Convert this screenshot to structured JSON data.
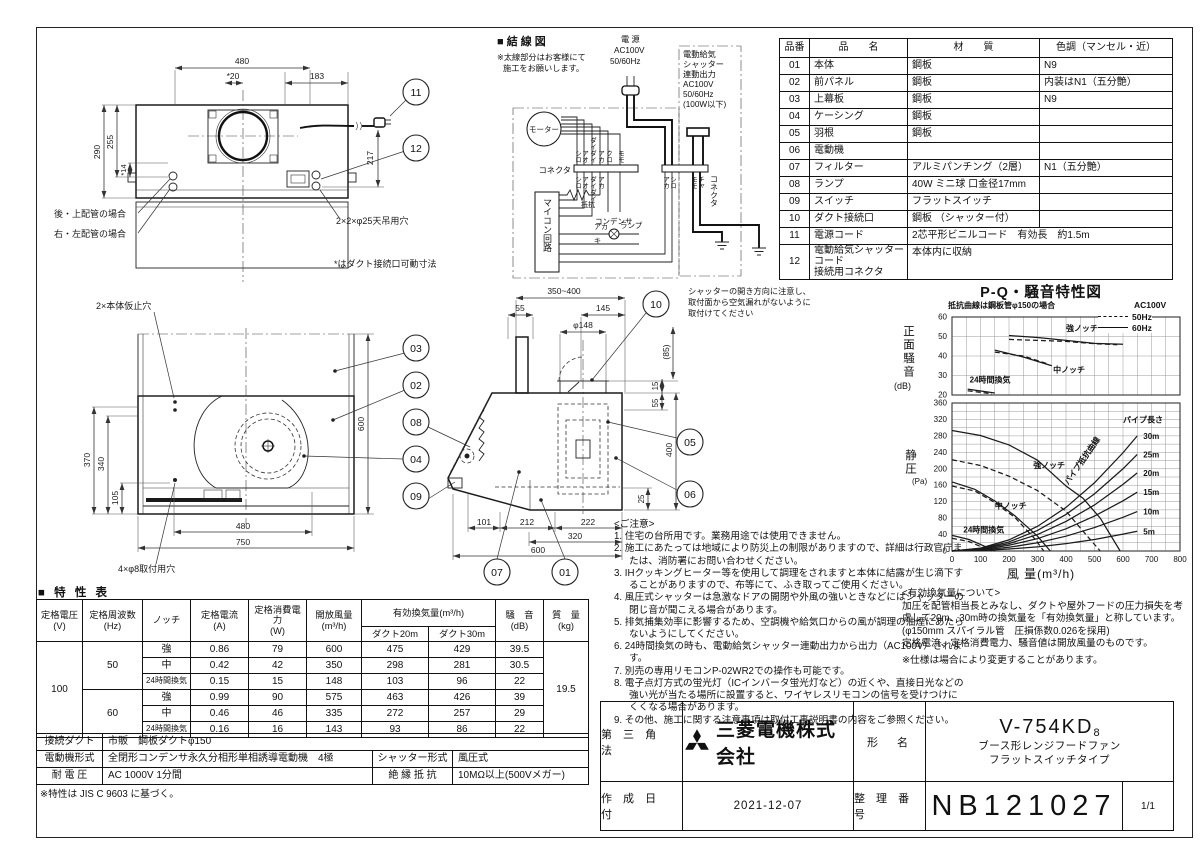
{
  "top_view": {
    "dims": {
      "w480": "480",
      "w20": "*20",
      "w183": "183",
      "h290": "290",
      "h255": "255",
      "h14": "*14",
      "h217": "217"
    },
    "labels": {
      "rear_top": "後・上配管の場合",
      "right_left": "右・左配管の場合",
      "ceiling_holes": "2×2×φ25天吊用穴",
      "movable_note": "*はダクト接続口可動寸法"
    },
    "callout_11": "11",
    "callout_12": "12"
  },
  "front_view": {
    "dims": {
      "h370": "370",
      "h340": "340",
      "h105": "105",
      "h600": "600",
      "w480": "480",
      "w750": "750"
    },
    "labels": {
      "temp_holes": "2×本体仮止穴",
      "mount_holes": "4×φ8取付用穴"
    },
    "callouts": {
      "c03": "03",
      "c02": "02",
      "c08": "08",
      "c04": "04",
      "c09": "09"
    }
  },
  "side_view": {
    "dims": {
      "w350400": "350~400",
      "w55": "55",
      "w145": "145",
      "d148": "φ148",
      "h85": "(85)",
      "h15": "15",
      "h55": "55",
      "h400": "400",
      "h25": "25",
      "w101": "101",
      "w212": "212",
      "w222": "222",
      "w320": "320",
      "w600": "600"
    },
    "note_lines": [
      "シャッターの開き方向に注意し、",
      "取付面から空気漏れがないように",
      "取付けてください"
    ],
    "callouts": {
      "c10": "10",
      "c05": "05",
      "c06": "06",
      "c07": "07",
      "c01": "01"
    }
  },
  "wiring": {
    "title": "■ 結 線 図",
    "note_line1": "※太線部分はお客様にて",
    "note_line2": "施工をお願いします。",
    "power": {
      "l1": "電 源",
      "l2": "AC100V",
      "l3": "50/60Hz"
    },
    "shutter_out": {
      "l1": "電動給気",
      "l2": "シャッター",
      "l3": "連動出力",
      "l4": "AC100V",
      "l5": "50/60Hz",
      "l6": "(100W以下)"
    },
    "motor": "モーター",
    "connector_l": "コネクタ",
    "connector_r": "コネクタ",
    "micon": "マイコン回路",
    "condenser": "コンデンサ",
    "resistor": "抵抗",
    "lamp": "ランプ",
    "wires_top": [
      "シロ",
      "アオ",
      "ダイダイ",
      "アカ",
      "クロ",
      "モモ"
    ],
    "wires_bottom": [
      "シロ",
      "アオ",
      "ダイダイ",
      "アカ"
    ],
    "wires_right": [
      "アカ",
      "シロ",
      "モモ",
      "チャ"
    ],
    "lamp_wire_red": "アカ",
    "lamp_wire_yellow": "キ"
  },
  "parts_table": {
    "headers": [
      "品番",
      "品　　名",
      "材　　質",
      "色調（マンセル・近）"
    ],
    "rows": [
      {
        "no": "01",
        "name": "本体",
        "material": "鋼板",
        "color": "N9"
      },
      {
        "no": "02",
        "name": "前パネル",
        "material": "鋼板",
        "color": "内装はN1（五分艶）"
      },
      {
        "no": "03",
        "name": "上幕板",
        "material": "鋼板",
        "color": "N9"
      },
      {
        "no": "04",
        "name": "ケーシング",
        "material": "鋼板",
        "color": ""
      },
      {
        "no": "05",
        "name": "羽根",
        "material": "鋼板",
        "color": ""
      },
      {
        "no": "06",
        "name": "電動機",
        "material": "",
        "color": ""
      },
      {
        "no": "07",
        "name": "フィルター",
        "material": "アルミパンチング（2層）",
        "color": "N1（五分艶）"
      },
      {
        "no": "08",
        "name": "ランプ",
        "material": "40W ミニ球 口金径17mm",
        "color": ""
      },
      {
        "no": "09",
        "name": "スイッチ",
        "material": "フラットスイッチ",
        "color": ""
      },
      {
        "no": "10",
        "name": "ダクト接続口",
        "material": "鋼板 （シャッター付）",
        "color": ""
      },
      {
        "no": "11",
        "name": "電源コード",
        "material": "2芯平形ビニルコード　有効長　約1.5m",
        "color": ""
      },
      {
        "no": "12",
        "name": "電動給気シャッターコード\n接続用コネクタ",
        "material": "本体内に収納",
        "color": ""
      }
    ]
  },
  "spec_table": {
    "title": "■ 特 性 表",
    "h": {
      "voltage": "定格電圧\n(V)",
      "freq": "定格周波数\n(Hz)",
      "notch": "ノッチ",
      "current": "定格電流\n(A)",
      "power": "定格消費電力\n(W)",
      "open_flow": "開放風量\n(m³/h)",
      "effective": "有効換気量(m³/h)",
      "duct20": "ダクト20m",
      "duct30": "ダクト30m",
      "noise": "騒　音\n(dB)",
      "mass": "質　量\n(kg)"
    },
    "voltage": "100",
    "mass": "19.5",
    "groups": [
      {
        "freq": "50",
        "rows": [
          {
            "notch": "強",
            "a": "0.86",
            "w": "79",
            "open": "600",
            "d20": "475",
            "d30": "429",
            "db": "39.5"
          },
          {
            "notch": "中",
            "a": "0.42",
            "w": "42",
            "open": "350",
            "d20": "298",
            "d30": "281",
            "db": "30.5"
          },
          {
            "notch": "24時間換気",
            "a": "0.15",
            "w": "15",
            "open": "148",
            "d20": "103",
            "d30": "96",
            "db": "22"
          }
        ]
      },
      {
        "freq": "60",
        "rows": [
          {
            "notch": "強",
            "a": "0.99",
            "w": "90",
            "open": "575",
            "d20": "463",
            "d30": "426",
            "db": "39"
          },
          {
            "notch": "中",
            "a": "0.46",
            "w": "46",
            "open": "335",
            "d20": "272",
            "d30": "257",
            "db": "29"
          },
          {
            "notch": "24時間換気",
            "a": "0.16",
            "w": "16",
            "open": "143",
            "d20": "93",
            "d30": "86",
            "db": "22"
          }
        ]
      }
    ],
    "bottom": {
      "duct_label": "接続ダクト",
      "duct_value": "市販　鋼板ダクトφ150",
      "motor_label": "電動機形式",
      "motor_value": "全閉形コンデンサ永久分相形単相誘導電動機　4極",
      "shutter_label": "シャッター形式",
      "shutter_value": "風圧式",
      "withstand_label": "耐 電 圧",
      "withstand_value": "AC 1000V 1分間",
      "insulation_label": "絶 縁 抵 抗",
      "insulation_value": "10MΩ以上(500Vメガー)"
    },
    "footnote": "※特性は JIS C 9603 に基づく。"
  },
  "notes": {
    "heading": "<ご注意>",
    "items": [
      "1. 住宅の台所用です。業務用途では使用できません。",
      "2. 施工にあたっては地域により防災上の制限がありますので、詳細は行政官庁または、消防署にお問い合わせください。",
      "3. IHクッキングヒーター等を使用して調理をされますと本体に結露が生じ滴下することがありますので、布等にて、ふき取ってご使用ください。",
      "4. 風圧式シャッターは急激なドアの開閉や外風の強いときなどにはシャッターの閉じ音が聞こえる場合があります。",
      "5. 排気捕集効率に影響するため、空調機や給気口からの風が調理の油煙にあたらないようにしてください。",
      "6. 24時間換気の時も、電動給気シャッター連動出力から出力（AC100V）されます。",
      "7. 別売の専用リモコンP-02WR2での操作も可能です。",
      "8. 電子点灯方式の蛍光灯（ICインバータ蛍光灯など）の近くや、直接日光などの強い光が当たる場所に設置すると、ワイヤレスリモコンの信号を受けつけにくくなる場合があります。",
      "9. その他、施工に関する注意事項は取付工事説明書の内容をご参照ください。"
    ]
  },
  "effective_note": {
    "heading": "<有効換気量について>",
    "body": "加圧を配管相当長とみなし、ダクトや屋外フードの圧力損失を考慮して20m、30m時の換気量を「有効換気量」と称しています。(φ150mm スパイラル管　圧損係数0.026を採用)",
    "body2": "定格電流、定格消費電力、騒音値は開放風量のものです。",
    "footnote": "※仕様は場合により変更することがあります。"
  },
  "title_block": {
    "projection": "第 三 角 法",
    "company": "三菱電機株式会社",
    "model_label": "形　名",
    "model": "V-754KD",
    "model_suffix": "8",
    "model_desc1": "ブース形レンジフードファン",
    "model_desc2": "フラットスイッチタイプ",
    "date_label": "作 成 日 付",
    "date": "2021-12-07",
    "number_label": "整 理 番 号",
    "number": "NB121027",
    "page": "1/1"
  },
  "chart_data": {
    "type": "line",
    "title": "P-Q・騒音特性図",
    "note": "抵抗曲線は鋼板管φ150の場合",
    "power_label": "AC100V",
    "legend": [
      {
        "name": "50Hz",
        "style": "dashed"
      },
      {
        "name": "60Hz",
        "style": "solid"
      }
    ],
    "noise_plot": {
      "ylabel": "正面騒音",
      "yunit": "(dB)",
      "ylim": [
        20,
        60
      ],
      "yticks": [
        20,
        30,
        40,
        50,
        60
      ],
      "series": [
        {
          "name": "強ノッチ 60Hz",
          "style": "solid",
          "points": [
            [
              200,
              50.5
            ],
            [
              300,
              49.5
            ],
            [
              400,
              48
            ],
            [
              500,
              46.5
            ],
            [
              600,
              46
            ]
          ]
        },
        {
          "name": "強ノッチ 50Hz",
          "style": "dashed",
          "points": [
            [
              200,
              48.5
            ],
            [
              300,
              48
            ],
            [
              400,
              47.5
            ],
            [
              500,
              46.3
            ],
            [
              580,
              45.8
            ]
          ]
        },
        {
          "name": "中ノッチ 60Hz",
          "style": "solid",
          "points": [
            [
              150,
              43
            ],
            [
              250,
              39.5
            ],
            [
              350,
              35
            ]
          ]
        },
        {
          "name": "中ノッチ 50Hz",
          "style": "dashed",
          "points": [
            [
              150,
              42
            ],
            [
              250,
              40
            ],
            [
              335,
              36
            ]
          ]
        },
        {
          "name": "24時間換気 60Hz",
          "style": "solid",
          "points": [
            [
              55,
              23
            ],
            [
              150,
              21
            ]
          ]
        },
        {
          "name": "24時間換気 50Hz",
          "style": "dashed",
          "points": [
            [
              55,
              22.2
            ],
            [
              140,
              20.6
            ]
          ]
        }
      ],
      "labels": [
        {
          "text": "強ノッチ",
          "x": 400,
          "y": 52.8
        },
        {
          "text": "中ノッチ",
          "x": 355,
          "y": 31.5
        },
        {
          "text": "24時間換気",
          "x": 62,
          "y": 26.5
        }
      ]
    },
    "pq_plot": {
      "ylabel": "静圧",
      "yunit": "(Pa)",
      "xlabel": "風 量(m³/h)",
      "ylim": [
        0,
        360
      ],
      "xlim": [
        0,
        800
      ],
      "yticks": [
        0,
        40,
        80,
        120,
        160,
        200,
        240,
        280,
        320,
        360
      ],
      "xticks": [
        0,
        100,
        200,
        300,
        400,
        500,
        600,
        700,
        800
      ],
      "fan_series": [
        {
          "name": "強ノッチ 60Hz",
          "style": "solid",
          "points": [
            [
              0,
              293
            ],
            [
              100,
              281
            ],
            [
              200,
              258
            ],
            [
              300,
              221
            ],
            [
              400,
              158
            ],
            [
              460,
              128
            ],
            [
              520,
              80
            ],
            [
              590,
              0
            ]
          ]
        },
        {
          "name": "強ノッチ 50Hz",
          "style": "dashed",
          "points": [
            [
              0,
              222
            ],
            [
              100,
              208
            ],
            [
              200,
              182
            ],
            [
              300,
              147
            ],
            [
              400,
              97
            ],
            [
              470,
              40
            ],
            [
              520,
              0
            ]
          ]
        },
        {
          "name": "中ノッチ 60Hz",
          "style": "solid",
          "points": [
            [
              0,
              168
            ],
            [
              80,
              150
            ],
            [
              150,
              122
            ],
            [
              220,
              86
            ],
            [
              300,
              36
            ],
            [
              345,
              0
            ]
          ]
        },
        {
          "name": "中ノッチ 50Hz",
          "style": "dashed",
          "points": [
            [
              0,
              158
            ],
            [
              80,
              146
            ],
            [
              150,
              118
            ],
            [
              220,
              82
            ],
            [
              290,
              30
            ],
            [
              322,
              0
            ]
          ]
        },
        {
          "name": "24時間換気 60Hz",
          "style": "solid",
          "points": [
            [
              0,
              38
            ],
            [
              60,
              28
            ],
            [
              110,
              13
            ],
            [
              152,
              0
            ]
          ]
        },
        {
          "name": "24時間換気 50Hz",
          "style": "dashed",
          "points": [
            [
              0,
              31
            ],
            [
              60,
              23
            ],
            [
              100,
              11
            ],
            [
              140,
              0
            ]
          ]
        }
      ],
      "pipe_header": "パイプ長さ",
      "pipe_series": [
        {
          "name": "30m",
          "points": [
            [
              0,
              0
            ],
            [
              100,
              7
            ],
            [
              200,
              27
            ],
            [
              300,
              60
            ],
            [
              400,
              106
            ],
            [
              500,
              166
            ],
            [
              600,
              239
            ],
            [
              650,
              280
            ]
          ]
        },
        {
          "name": "25m",
          "points": [
            [
              0,
              0
            ],
            [
              100,
              6
            ],
            [
              200,
              22
            ],
            [
              300,
              50
            ],
            [
              400,
              89
            ],
            [
              500,
              139
            ],
            [
              600,
              200
            ],
            [
              650,
              235
            ]
          ]
        },
        {
          "name": "20m",
          "points": [
            [
              0,
              0
            ],
            [
              100,
              5
            ],
            [
              200,
              18
            ],
            [
              300,
              40
            ],
            [
              400,
              72
            ],
            [
              500,
              112
            ],
            [
              600,
              162
            ],
            [
              650,
              190
            ]
          ]
        },
        {
          "name": "15m",
          "points": [
            [
              0,
              0
            ],
            [
              100,
              3
            ],
            [
              200,
              14
            ],
            [
              300,
              30
            ],
            [
              400,
              54
            ],
            [
              500,
              85
            ],
            [
              600,
              122
            ],
            [
              650,
              143
            ]
          ]
        },
        {
          "name": "10m",
          "points": [
            [
              0,
              0
            ],
            [
              100,
              2
            ],
            [
              200,
              9
            ],
            [
              300,
              20
            ],
            [
              400,
              36
            ],
            [
              500,
              57
            ],
            [
              600,
              82
            ],
            [
              650,
              96
            ]
          ]
        },
        {
          "name": "5m",
          "points": [
            [
              0,
              0
            ],
            [
              100,
              1
            ],
            [
              200,
              5
            ],
            [
              300,
              10
            ],
            [
              400,
              18
            ],
            [
              500,
              28
            ],
            [
              600,
              41
            ],
            [
              650,
              48
            ]
          ]
        }
      ],
      "labels": [
        {
          "text": "強ノッチ",
          "x": 285,
          "y": 202
        },
        {
          "text": "中ノッチ",
          "x": 150,
          "y": 103
        },
        {
          "text": "24時間換気",
          "x": 40,
          "y": 45
        },
        {
          "text": "パイプ長さ",
          "x": 600,
          "y": 312
        },
        {
          "text": "パイプ抵抗曲線",
          "x": 408,
          "y": 160,
          "rot": -55
        }
      ]
    }
  }
}
